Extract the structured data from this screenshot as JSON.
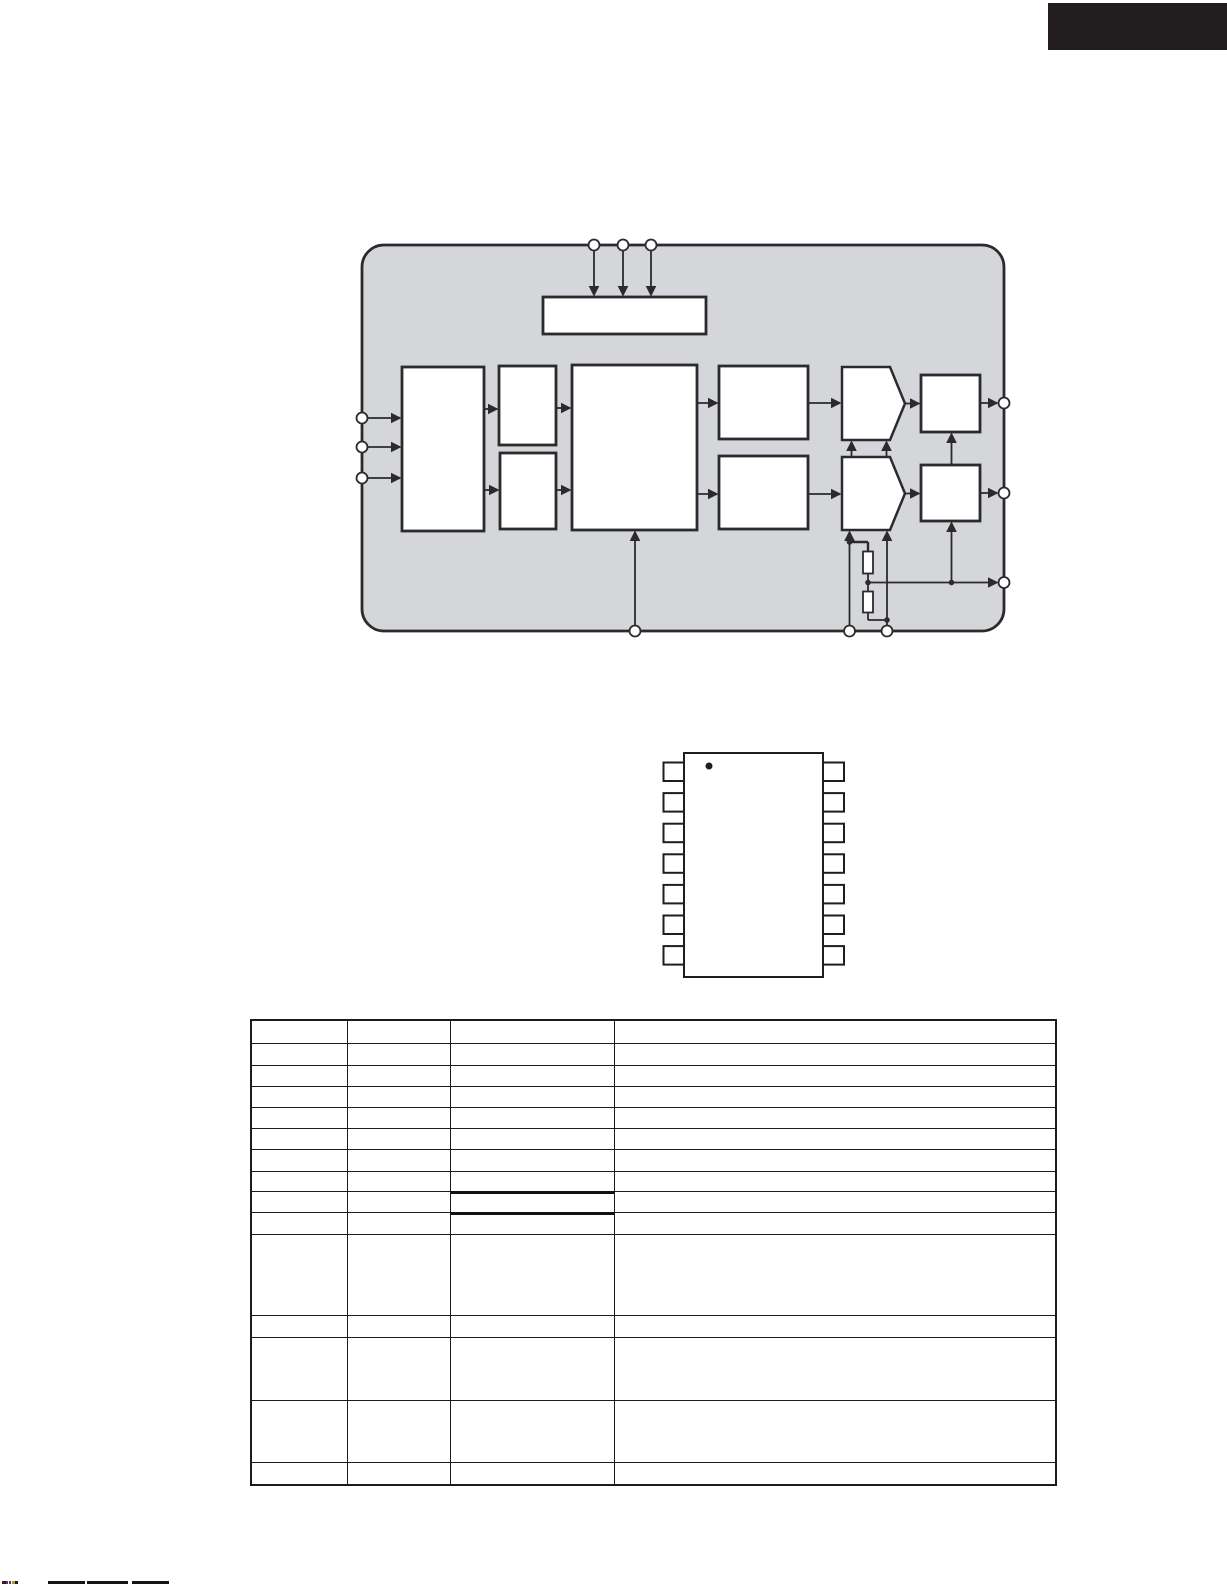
{
  "page": {
    "width": 1227,
    "height": 1587,
    "background": "#ffffff"
  },
  "banner": {
    "x": 1048,
    "y": 3,
    "w": 179,
    "h": 47,
    "color": "#221e1f"
  },
  "block_diagram": {
    "colors": {
      "panel_fill": "#d5d6d9",
      "line": "#2b2b2e",
      "block_fill": "#ffffff"
    },
    "container": {
      "x": 362,
      "y": 245,
      "w": 642,
      "h": 386,
      "r": 22
    },
    "blocks": [
      {
        "name": "control-bar-block",
        "x": 543,
        "y": 297,
        "w": 163,
        "h": 37
      },
      {
        "name": "input-block",
        "x": 402,
        "y": 367,
        "w": 82,
        "h": 164
      },
      {
        "name": "upper-small-block",
        "x": 499,
        "y": 366,
        "w": 57,
        "h": 79
      },
      {
        "name": "lower-small-block",
        "x": 500,
        "y": 453,
        "w": 56,
        "h": 76
      },
      {
        "name": "core-block",
        "x": 572,
        "y": 365,
        "w": 125,
        "h": 165
      },
      {
        "name": "upper-mid-block",
        "x": 719,
        "y": 366,
        "w": 89,
        "h": 73
      },
      {
        "name": "lower-mid-block",
        "x": 719,
        "y": 456,
        "w": 89,
        "h": 73
      },
      {
        "name": "upper-output-block",
        "x": 921,
        "y": 375,
        "w": 59,
        "h": 57
      },
      {
        "name": "lower-output-block",
        "x": 921,
        "y": 465,
        "w": 59,
        "h": 56
      }
    ],
    "pentagons": [
      {
        "name": "upper-amp-block",
        "points": "842,367 890,367 905,403.5 890,440 842,440"
      },
      {
        "name": "lower-amp-block",
        "points": "842,457 890,457 905,493.5 890,530 842,530"
      }
    ],
    "resistors": [
      {
        "name": "resistor-upper",
        "x": 863,
        "y": 551.5,
        "w": 10,
        "h": 22
      },
      {
        "name": "resistor-lower",
        "x": 863,
        "y": 591.5,
        "w": 10,
        "h": 21
      }
    ],
    "arrows": [
      [
        594,
        250,
        594,
        295
      ],
      [
        623,
        250,
        623,
        295
      ],
      [
        651,
        250,
        651,
        295
      ],
      [
        367,
        418,
        400,
        418
      ],
      [
        367,
        447,
        400,
        447
      ],
      [
        367,
        478,
        400,
        478
      ],
      [
        484,
        409,
        497,
        409
      ],
      [
        484,
        490,
        498,
        490
      ],
      [
        556,
        408,
        570,
        408
      ],
      [
        556,
        490,
        570,
        490
      ],
      [
        697,
        403,
        717,
        403
      ],
      [
        697,
        494,
        717,
        494
      ],
      [
        808,
        403,
        840,
        403
      ],
      [
        808,
        494,
        840,
        494
      ],
      [
        905,
        403.5,
        919,
        403.5
      ],
      [
        905,
        493.5,
        919,
        493.5
      ],
      [
        980,
        403,
        997,
        403
      ],
      [
        980,
        493,
        997,
        493
      ],
      [
        868,
        582.5,
        997,
        582.5
      ],
      [
        951.5,
        465,
        951.5,
        434
      ],
      [
        951.5,
        580,
        951.5,
        523
      ],
      [
        851.5,
        457,
        851.5,
        442
      ],
      [
        886.5,
        457,
        886.5,
        442
      ],
      [
        849.5,
        626,
        849.5,
        532
      ],
      [
        887,
        626,
        887,
        532
      ],
      [
        635,
        626,
        635,
        532
      ]
    ],
    "lines": [
      [
        849.5,
        542,
        868,
        542,
        2.4
      ],
      [
        868,
        542,
        868,
        551.5,
        2.4
      ],
      [
        868,
        573.5,
        868,
        591.5,
        1.8
      ],
      [
        868,
        612.5,
        868,
        620,
        1.8
      ],
      [
        868,
        620,
        887,
        620,
        1.8
      ]
    ],
    "pins": [
      [
        594,
        245
      ],
      [
        623,
        245
      ],
      [
        651,
        245
      ],
      [
        362,
        418
      ],
      [
        362,
        447
      ],
      [
        362,
        478
      ],
      [
        1004,
        403
      ],
      [
        1004,
        493
      ],
      [
        1004,
        582.5
      ],
      [
        635,
        631
      ],
      [
        849.5,
        631
      ],
      [
        887,
        631
      ]
    ],
    "dots": [
      [
        849.5,
        542
      ],
      [
        868,
        582.5
      ],
      [
        951.5,
        582.5
      ],
      [
        887,
        620
      ]
    ]
  },
  "ic_package": {
    "line": "#1e1e1f",
    "body": {
      "x": 684,
      "y": 753,
      "w": 139,
      "h": 224
    },
    "pin1_dot": {
      "cx": 709,
      "cy": 766,
      "r": 3.5
    },
    "pins_per_side": 7,
    "pin": {
      "w": 21,
      "h": 18.5,
      "pitch": 30.6,
      "first_y": 762.5,
      "left_x": 663.5,
      "right_x": 823
    }
  },
  "pin_table": {
    "x": 250,
    "y": 1019,
    "col_widths": [
      95,
      103,
      164,
      441
    ],
    "row_heights": [
      22,
      22,
      21,
      21,
      21,
      21,
      22,
      20,
      21,
      22,
      81,
      22,
      63,
      62,
      22
    ],
    "thick_top_cells": [
      {
        "row": 8,
        "col": 2
      },
      {
        "row": 9,
        "col": 2
      }
    ],
    "cells_empty": true
  },
  "footer_marks": {
    "y": 1581,
    "h": 3,
    "segments": [
      {
        "x": 2,
        "w": 4,
        "c": "#222222"
      },
      {
        "x": 6,
        "w": 2,
        "c": "#a02030"
      },
      {
        "x": 9,
        "w": 2,
        "c": "#304090"
      },
      {
        "x": 12,
        "w": 3,
        "c": "#b89a10"
      },
      {
        "x": 15,
        "w": 3,
        "c": "#222222"
      },
      {
        "x": 48,
        "w": 37,
        "c": "#151515"
      },
      {
        "x": 87,
        "w": 41,
        "c": "#151515"
      },
      {
        "x": 132,
        "w": 37,
        "c": "#151515"
      }
    ]
  }
}
